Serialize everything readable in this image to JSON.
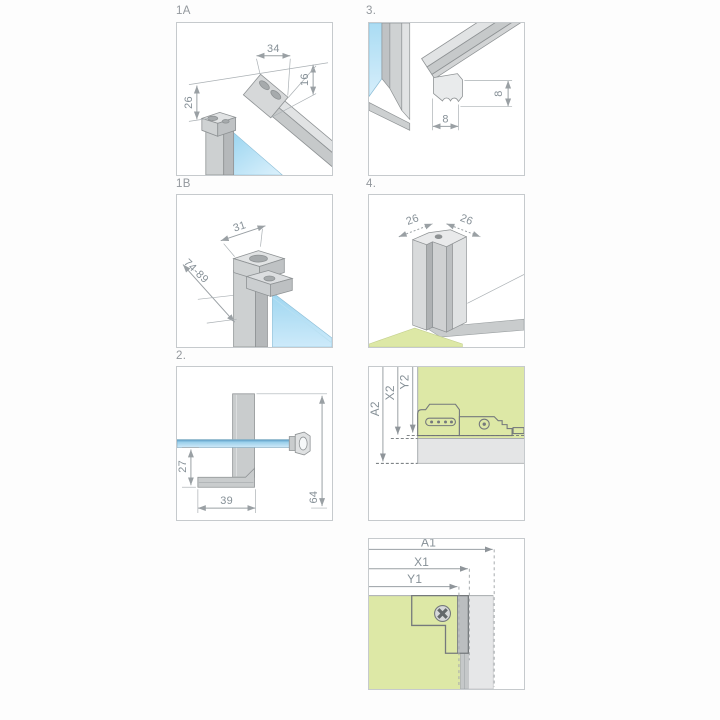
{
  "colors": {
    "panel_border": "#c6cacd",
    "label_text": "#93989d",
    "dim_text": "#869097",
    "dim_line": "#9aa0a4",
    "outline": "#8e9294",
    "metal_light": "#e1e3e4",
    "metal_mid": "#cfd2d3",
    "metal_dark": "#b5b8ba",
    "glass_deep": "#8fd0ee",
    "glass_pale": "#dcf1fc",
    "floor_green": "#dde8a6",
    "band_gray": "#e4e5e6",
    "dash_dark": "#6f7478"
  },
  "panels": {
    "p1a": {
      "label": "1A",
      "dim_width": "34",
      "dim_height": "16",
      "dim_offset": "26"
    },
    "p3": {
      "label": "3.",
      "dim_width": "8",
      "dim_height": "8"
    },
    "p1b": {
      "label": "1B",
      "dim_width": "31",
      "dim_range": "74-89"
    },
    "p4": {
      "label": "4.",
      "dim_left": "26",
      "dim_right": "26"
    },
    "p2": {
      "label": "2.",
      "dim_drop": "27",
      "dim_foot": "39",
      "dim_height": "64"
    },
    "pa2": {
      "dim_a": "A2",
      "dim_x": "X2",
      "dim_y": "Y2"
    },
    "pa1": {
      "dim_a": "A1",
      "dim_x": "X1",
      "dim_y": "Y1"
    }
  }
}
